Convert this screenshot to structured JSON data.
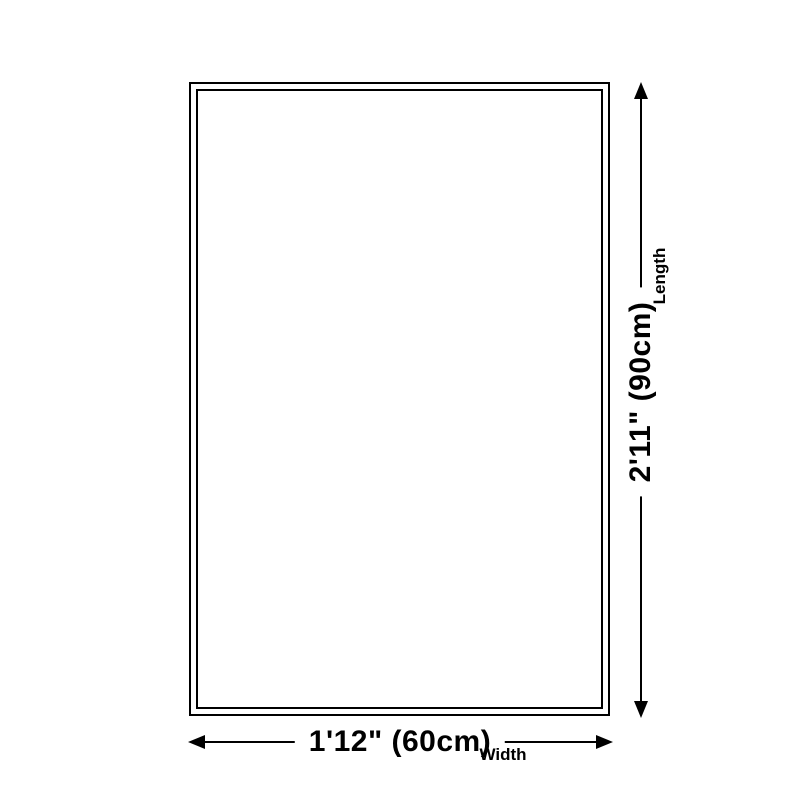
{
  "page": {
    "background_color": "#ffffff",
    "line_color": "#000000"
  },
  "diagram": {
    "length": {
      "value": "2'11\" (90cm)",
      "label": "Length"
    },
    "width": {
      "value": "1'12\" (60cm)",
      "label": "Width"
    }
  }
}
